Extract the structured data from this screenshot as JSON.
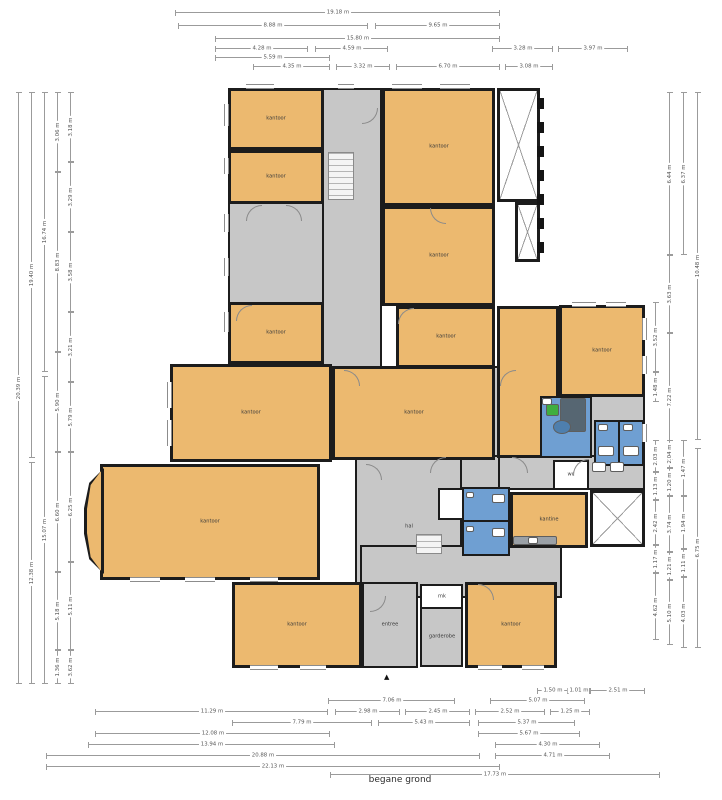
{
  "title": "begane grond",
  "colors": {
    "room_fill": "#ecb96f",
    "hall_fill": "#c7c7c7",
    "wet_fill": "#6f9fd2",
    "wall": "#1c1c1c",
    "dimension_line": "#9b9b9b"
  },
  "plan": {
    "rooms": [
      {
        "type": "hall",
        "x": 322,
        "y": 88,
        "w": 60,
        "h": 282,
        "label": ""
      },
      {
        "type": "hall",
        "x": 228,
        "y": 202,
        "w": 96,
        "h": 102,
        "label": ""
      },
      {
        "type": "hall",
        "x": 322,
        "y": 366,
        "w": 323,
        "h": 94,
        "label": ""
      },
      {
        "type": "hall",
        "x": 495,
        "y": 455,
        "w": 150,
        "h": 35,
        "label": ""
      },
      {
        "type": "hall",
        "x": 460,
        "y": 455,
        "w": 40,
        "h": 36,
        "label": ""
      },
      {
        "type": "hall",
        "x": 355,
        "y": 455,
        "w": 107,
        "h": 143,
        "label": "hal"
      },
      {
        "type": "hall",
        "x": 360,
        "y": 545,
        "w": 202,
        "h": 53,
        "label": ""
      },
      {
        "type": "hall",
        "x": 362,
        "y": 582,
        "w": 56,
        "h": 86,
        "label": "entree"
      },
      {
        "type": "hall",
        "x": 420,
        "y": 607,
        "w": 43,
        "h": 60,
        "label": "garderobe"
      },
      {
        "type": "void",
        "x": 497,
        "y": 88,
        "w": 43,
        "h": 114,
        "label": ""
      },
      {
        "type": "void",
        "x": 515,
        "y": 202,
        "w": 25,
        "h": 60,
        "label": ""
      },
      {
        "type": "void",
        "x": 590,
        "y": 490,
        "w": 55,
        "h": 57,
        "label": ""
      },
      {
        "type": "office",
        "x": 228,
        "y": 88,
        "w": 96,
        "h": 62,
        "label": "kantoor"
      },
      {
        "type": "office",
        "x": 228,
        "y": 150,
        "w": 96,
        "h": 54,
        "label": "kantoor"
      },
      {
        "type": "office",
        "x": 228,
        "y": 302,
        "w": 96,
        "h": 62,
        "label": "kantoor"
      },
      {
        "type": "office",
        "x": 382,
        "y": 88,
        "w": 113,
        "h": 118,
        "label": "kantoor"
      },
      {
        "type": "office",
        "x": 382,
        "y": 206,
        "w": 113,
        "h": 100,
        "label": "kantoor"
      },
      {
        "type": "office",
        "x": 396,
        "y": 306,
        "w": 99,
        "h": 62,
        "label": "kantoor"
      },
      {
        "type": "office",
        "x": 170,
        "y": 364,
        "w": 162,
        "h": 98,
        "label": "kantoor"
      },
      {
        "type": "office",
        "x": 332,
        "y": 366,
        "w": 163,
        "h": 94,
        "label": "kantoor"
      },
      {
        "type": "office",
        "x": 497,
        "y": 306,
        "w": 62,
        "h": 152,
        "label": ""
      },
      {
        "type": "office",
        "x": 559,
        "y": 305,
        "w": 86,
        "h": 92,
        "label": "kantoor"
      },
      {
        "type": "office",
        "x": 100,
        "y": 464,
        "w": 220,
        "h": 116,
        "label": "kantoor"
      },
      {
        "type": "office",
        "x": 510,
        "y": 492,
        "w": 78,
        "h": 56,
        "label": "kantine"
      },
      {
        "type": "office",
        "x": 232,
        "y": 582,
        "w": 130,
        "h": 86,
        "label": "kantoor"
      },
      {
        "type": "office",
        "x": 465,
        "y": 582,
        "w": 92,
        "h": 86,
        "label": "kantoor"
      },
      {
        "type": "room-white",
        "x": 420,
        "y": 584,
        "w": 43,
        "h": 25,
        "label": "mk"
      },
      {
        "type": "room-white",
        "x": 438,
        "y": 488,
        "w": 26,
        "h": 32,
        "label": ""
      },
      {
        "type": "room-white",
        "x": 553,
        "y": 460,
        "w": 36,
        "h": 30,
        "label": "wc"
      },
      {
        "type": "wet",
        "x": 540,
        "y": 396,
        "w": 52,
        "h": 62,
        "label": ""
      },
      {
        "type": "wet",
        "x": 594,
        "y": 420,
        "w": 26,
        "h": 46,
        "label": ""
      },
      {
        "type": "wet",
        "x": 618,
        "y": 420,
        "w": 26,
        "h": 46,
        "label": ""
      },
      {
        "type": "wet",
        "x": 462,
        "y": 487,
        "w": 48,
        "h": 35,
        "label": ""
      },
      {
        "type": "wet",
        "x": 462,
        "y": 520,
        "w": 48,
        "h": 36,
        "label": ""
      }
    ],
    "features": [
      {
        "t": "bay",
        "x": 84,
        "y": 468,
        "w": 20,
        "h": 106
      },
      {
        "t": "win-h",
        "x": 246,
        "y": 84,
        "l": 28
      },
      {
        "t": "win-h",
        "x": 338,
        "y": 84,
        "l": 16
      },
      {
        "t": "win-h",
        "x": 392,
        "y": 84,
        "l": 30
      },
      {
        "t": "win-h",
        "x": 440,
        "y": 84,
        "l": 30
      },
      {
        "t": "win-h",
        "x": 572,
        "y": 302,
        "l": 24
      },
      {
        "t": "win-h",
        "x": 606,
        "y": 302,
        "l": 20
      },
      {
        "t": "win-h",
        "x": 130,
        "y": 577,
        "l": 30
      },
      {
        "t": "win-h",
        "x": 185,
        "y": 577,
        "l": 30
      },
      {
        "t": "win-h",
        "x": 250,
        "y": 577,
        "l": 28
      },
      {
        "t": "win-h",
        "x": 250,
        "y": 665,
        "l": 28
      },
      {
        "t": "win-h",
        "x": 300,
        "y": 665,
        "l": 26
      },
      {
        "t": "win-h",
        "x": 478,
        "y": 665,
        "l": 24
      },
      {
        "t": "win-h",
        "x": 522,
        "y": 665,
        "l": 22
      },
      {
        "t": "win-v",
        "x": 224,
        "y": 104,
        "l": 22
      },
      {
        "t": "win-v",
        "x": 224,
        "y": 158,
        "l": 16
      },
      {
        "t": "win-v",
        "x": 224,
        "y": 214,
        "l": 18
      },
      {
        "t": "win-v",
        "x": 224,
        "y": 258,
        "l": 18
      },
      {
        "t": "win-v",
        "x": 224,
        "y": 312,
        "l": 20
      },
      {
        "t": "win-v",
        "x": 167,
        "y": 382,
        "l": 26
      },
      {
        "t": "win-v",
        "x": 167,
        "y": 420,
        "l": 26
      },
      {
        "t": "win-v",
        "x": 642,
        "y": 318,
        "l": 22
      },
      {
        "t": "win-v",
        "x": 642,
        "y": 356,
        "l": 18
      },
      {
        "t": "win-v",
        "x": 642,
        "y": 424,
        "l": 18
      },
      {
        "t": "dash",
        "x": 537,
        "y": 98,
        "w": 7,
        "h": 11
      },
      {
        "t": "dash",
        "x": 537,
        "y": 122,
        "w": 7,
        "h": 11
      },
      {
        "t": "dash",
        "x": 537,
        "y": 146,
        "w": 7,
        "h": 11
      },
      {
        "t": "dash",
        "x": 537,
        "y": 170,
        "w": 7,
        "h": 11
      },
      {
        "t": "dash",
        "x": 537,
        "y": 194,
        "w": 7,
        "h": 11
      },
      {
        "t": "dash",
        "x": 537,
        "y": 218,
        "w": 7,
        "h": 11
      },
      {
        "t": "dash",
        "x": 537,
        "y": 242,
        "w": 7,
        "h": 11
      },
      {
        "t": "door",
        "x": 246,
        "y": 205,
        "s": 16,
        "r": 0
      },
      {
        "t": "door",
        "x": 286,
        "y": 205,
        "s": 16,
        "r": 90
      },
      {
        "t": "door",
        "x": 236,
        "y": 305,
        "s": 16,
        "r": 0
      },
      {
        "t": "door",
        "x": 362,
        "y": 108,
        "s": 16,
        "r": 180
      },
      {
        "t": "door",
        "x": 430,
        "y": 208,
        "s": 16,
        "r": 270
      },
      {
        "t": "door",
        "x": 398,
        "y": 308,
        "s": 16,
        "r": 0
      },
      {
        "t": "door",
        "x": 344,
        "y": 370,
        "s": 16,
        "r": 90
      },
      {
        "t": "door",
        "x": 500,
        "y": 370,
        "s": 16,
        "r": 0
      },
      {
        "t": "door",
        "x": 366,
        "y": 464,
        "s": 16,
        "r": 90
      },
      {
        "t": "door",
        "x": 430,
        "y": 457,
        "s": 16,
        "r": 0
      },
      {
        "t": "door",
        "x": 512,
        "y": 457,
        "s": 16,
        "r": 90
      },
      {
        "t": "door",
        "x": 573,
        "y": 459,
        "s": 16,
        "r": 0
      },
      {
        "t": "door",
        "x": 370,
        "y": 596,
        "s": 16,
        "r": 180
      },
      {
        "t": "door",
        "x": 478,
        "y": 584,
        "s": 16,
        "r": 90
      },
      {
        "t": "stairs",
        "x": 328,
        "y": 152,
        "w": 26,
        "h": 48
      },
      {
        "t": "stairs",
        "x": 416,
        "y": 534,
        "w": 26,
        "h": 20
      },
      {
        "t": "fix",
        "n": "desk",
        "x": 560,
        "y": 398,
        "w": 26,
        "h": 34,
        "c": "#566672"
      },
      {
        "t": "fix",
        "n": "chair",
        "x": 546,
        "y": 404,
        "w": 13,
        "h": 12,
        "c": "#3fae3f"
      },
      {
        "t": "fix",
        "n": "table",
        "x": 553,
        "y": 420,
        "w": 18,
        "h": 14,
        "c": "#4e7fae",
        "round": true
      },
      {
        "t": "fix",
        "n": "toilet",
        "x": 598,
        "y": 446,
        "w": 16,
        "h": 10,
        "c": "#fff"
      },
      {
        "t": "fix",
        "n": "toilet",
        "x": 623,
        "y": 446,
        "w": 16,
        "h": 10,
        "c": "#fff"
      },
      {
        "t": "fix",
        "n": "sink",
        "x": 598,
        "y": 424,
        "w": 10,
        "h": 7,
        "c": "#fff"
      },
      {
        "t": "fix",
        "n": "sink",
        "x": 623,
        "y": 424,
        "w": 10,
        "h": 7,
        "c": "#fff"
      },
      {
        "t": "fix",
        "n": "toilet",
        "x": 492,
        "y": 494,
        "w": 13,
        "h": 9,
        "c": "#fff"
      },
      {
        "t": "fix",
        "n": "toilet",
        "x": 492,
        "y": 528,
        "w": 13,
        "h": 9,
        "c": "#fff"
      },
      {
        "t": "fix",
        "n": "sink",
        "x": 466,
        "y": 492,
        "w": 8,
        "h": 6,
        "c": "#fff"
      },
      {
        "t": "fix",
        "n": "sink",
        "x": 466,
        "y": 526,
        "w": 8,
        "h": 6,
        "c": "#fff"
      },
      {
        "t": "fix",
        "n": "counter",
        "x": 513,
        "y": 536,
        "w": 44,
        "h": 9,
        "c": "#9aa0a6"
      },
      {
        "t": "fix",
        "n": "sink",
        "x": 528,
        "y": 537,
        "w": 10,
        "h": 7,
        "c": "#fff"
      },
      {
        "t": "fix",
        "n": "appliance",
        "x": 592,
        "y": 462,
        "w": 14,
        "h": 10,
        "c": "#fff"
      },
      {
        "t": "fix",
        "n": "appliance",
        "x": 610,
        "y": 462,
        "w": 14,
        "h": 10,
        "c": "#fff"
      },
      {
        "t": "fix",
        "n": "sink",
        "x": 542,
        "y": 398,
        "w": 10,
        "h": 7,
        "c": "#fff"
      },
      {
        "t": "arrow",
        "x": 384,
        "y": 674
      }
    ]
  },
  "dimensions": {
    "h": [
      {
        "x": 175,
        "y": 12,
        "l": 325,
        "label": "19.18 m"
      },
      {
        "x": 178,
        "y": 25,
        "l": 190,
        "label": "8.88 m"
      },
      {
        "x": 375,
        "y": 25,
        "l": 125,
        "label": "9.65 m"
      },
      {
        "x": 215,
        "y": 38,
        "l": 285,
        "label": "15.80 m"
      },
      {
        "x": 215,
        "y": 48,
        "l": 93,
        "label": "4.28 m"
      },
      {
        "x": 315,
        "y": 48,
        "l": 73,
        "label": "4.59 m"
      },
      {
        "x": 492,
        "y": 48,
        "l": 61,
        "label": "3.28 m"
      },
      {
        "x": 558,
        "y": 48,
        "l": 70,
        "label": "3.97 m"
      },
      {
        "x": 215,
        "y": 57,
        "l": 115,
        "label": "5.59 m"
      },
      {
        "x": 253,
        "y": 66,
        "l": 77,
        "label": "4.35 m"
      },
      {
        "x": 336,
        "y": 66,
        "l": 54,
        "label": "3.32 m"
      },
      {
        "x": 396,
        "y": 66,
        "l": 104,
        "label": "6.70 m"
      },
      {
        "x": 505,
        "y": 66,
        "l": 48,
        "label": "3.08 m"
      },
      {
        "x": 537,
        "y": 690,
        "l": 31,
        "label": "1.50 m"
      },
      {
        "x": 568,
        "y": 690,
        "l": 22,
        "label": "1.01 m"
      },
      {
        "x": 590,
        "y": 690,
        "l": 55,
        "label": "2.51 m"
      },
      {
        "x": 328,
        "y": 700,
        "l": 127,
        "label": "7.06 m"
      },
      {
        "x": 490,
        "y": 700,
        "l": 95,
        "label": "5.07 m"
      },
      {
        "x": 95,
        "y": 711,
        "l": 233,
        "label": "11.29 m"
      },
      {
        "x": 335,
        "y": 711,
        "l": 65,
        "label": "2.98 m"
      },
      {
        "x": 405,
        "y": 711,
        "l": 65,
        "label": "2.45 m"
      },
      {
        "x": 475,
        "y": 711,
        "l": 70,
        "label": "2.52 m"
      },
      {
        "x": 550,
        "y": 711,
        "l": 40,
        "label": "1.25 m"
      },
      {
        "x": 232,
        "y": 722,
        "l": 140,
        "label": "7.79 m"
      },
      {
        "x": 378,
        "y": 722,
        "l": 92,
        "label": "5.43 m"
      },
      {
        "x": 478,
        "y": 722,
        "l": 97,
        "label": "5.37 m"
      },
      {
        "x": 95,
        "y": 733,
        "l": 235,
        "label": "12.08 m"
      },
      {
        "x": 478,
        "y": 733,
        "l": 102,
        "label": "5.67 m"
      },
      {
        "x": 88,
        "y": 744,
        "l": 247,
        "label": "13.94 m"
      },
      {
        "x": 495,
        "y": 744,
        "l": 105,
        "label": "4.30 m"
      },
      {
        "x": 46,
        "y": 755,
        "l": 434,
        "label": "20.88 m"
      },
      {
        "x": 495,
        "y": 755,
        "l": 115,
        "label": "4.71 m"
      },
      {
        "x": 46,
        "y": 766,
        "l": 454,
        "label": "22.13 m"
      },
      {
        "x": 330,
        "y": 774,
        "l": 330,
        "label": "17.73 m"
      }
    ],
    "v": [
      {
        "x": 18,
        "y": 92,
        "l": 592,
        "label": "20.39 m"
      },
      {
        "x": 31,
        "y": 92,
        "l": 366,
        "label": "19.40 m"
      },
      {
        "x": 31,
        "y": 462,
        "l": 222,
        "label": "12.38 m"
      },
      {
        "x": 44,
        "y": 92,
        "l": 280,
        "label": "16.74 m"
      },
      {
        "x": 44,
        "y": 376,
        "l": 308,
        "label": "15.07 m"
      },
      {
        "x": 57,
        "y": 92,
        "l": 80,
        "label": "3.06 m"
      },
      {
        "x": 57,
        "y": 172,
        "l": 180,
        "label": "8.83 m"
      },
      {
        "x": 57,
        "y": 352,
        "l": 100,
        "label": "5.90 m"
      },
      {
        "x": 57,
        "y": 452,
        "l": 120,
        "label": "6.60 m"
      },
      {
        "x": 57,
        "y": 572,
        "l": 78,
        "label": "5.18 m"
      },
      {
        "x": 57,
        "y": 650,
        "l": 34,
        "label": "1.36 m"
      },
      {
        "x": 70,
        "y": 92,
        "l": 70,
        "label": "3.18 m"
      },
      {
        "x": 70,
        "y": 162,
        "l": 70,
        "label": "3.29 m"
      },
      {
        "x": 70,
        "y": 232,
        "l": 80,
        "label": "3.58 m"
      },
      {
        "x": 70,
        "y": 312,
        "l": 70,
        "label": "3.21 m"
      },
      {
        "x": 70,
        "y": 382,
        "l": 70,
        "label": "5.79 m"
      },
      {
        "x": 70,
        "y": 452,
        "l": 110,
        "label": "6.25 m"
      },
      {
        "x": 70,
        "y": 562,
        "l": 88,
        "label": "5.11 m"
      },
      {
        "x": 70,
        "y": 650,
        "l": 34,
        "label": "3.62 m"
      },
      {
        "x": 655,
        "y": 302,
        "l": 70,
        "label": "3.52 m"
      },
      {
        "x": 655,
        "y": 372,
        "l": 30,
        "label": "1.48 m"
      },
      {
        "x": 669,
        "y": 92,
        "l": 163,
        "label": "6.44 m"
      },
      {
        "x": 669,
        "y": 255,
        "l": 78,
        "label": "3.63 m"
      },
      {
        "x": 669,
        "y": 333,
        "l": 127,
        "label": "7.22 m"
      },
      {
        "x": 683,
        "y": 92,
        "l": 163,
        "label": "6.37 m"
      },
      {
        "x": 697,
        "y": 92,
        "l": 348,
        "label": "10.48 m"
      },
      {
        "x": 655,
        "y": 440,
        "l": 32,
        "label": "2.03 m"
      },
      {
        "x": 655,
        "y": 472,
        "l": 28,
        "label": "1.13 m"
      },
      {
        "x": 655,
        "y": 500,
        "l": 45,
        "label": "2.42 m"
      },
      {
        "x": 655,
        "y": 545,
        "l": 28,
        "label": "1.17 m"
      },
      {
        "x": 655,
        "y": 573,
        "l": 67,
        "label": "4.62 m"
      },
      {
        "x": 669,
        "y": 440,
        "l": 28,
        "label": "2.04 m"
      },
      {
        "x": 669,
        "y": 468,
        "l": 28,
        "label": "1.20 m"
      },
      {
        "x": 669,
        "y": 496,
        "l": 56,
        "label": "3.74 m"
      },
      {
        "x": 669,
        "y": 552,
        "l": 28,
        "label": "1.21 m"
      },
      {
        "x": 669,
        "y": 580,
        "l": 65,
        "label": "5.10 m"
      },
      {
        "x": 683,
        "y": 440,
        "l": 56,
        "label": "1.47 m"
      },
      {
        "x": 683,
        "y": 496,
        "l": 53,
        "label": "1.94 m"
      },
      {
        "x": 683,
        "y": 549,
        "l": 28,
        "label": "1.11 m"
      },
      {
        "x": 683,
        "y": 577,
        "l": 71,
        "label": "4.03 m"
      },
      {
        "x": 697,
        "y": 448,
        "l": 200,
        "label": "6.75 m"
      }
    ]
  }
}
